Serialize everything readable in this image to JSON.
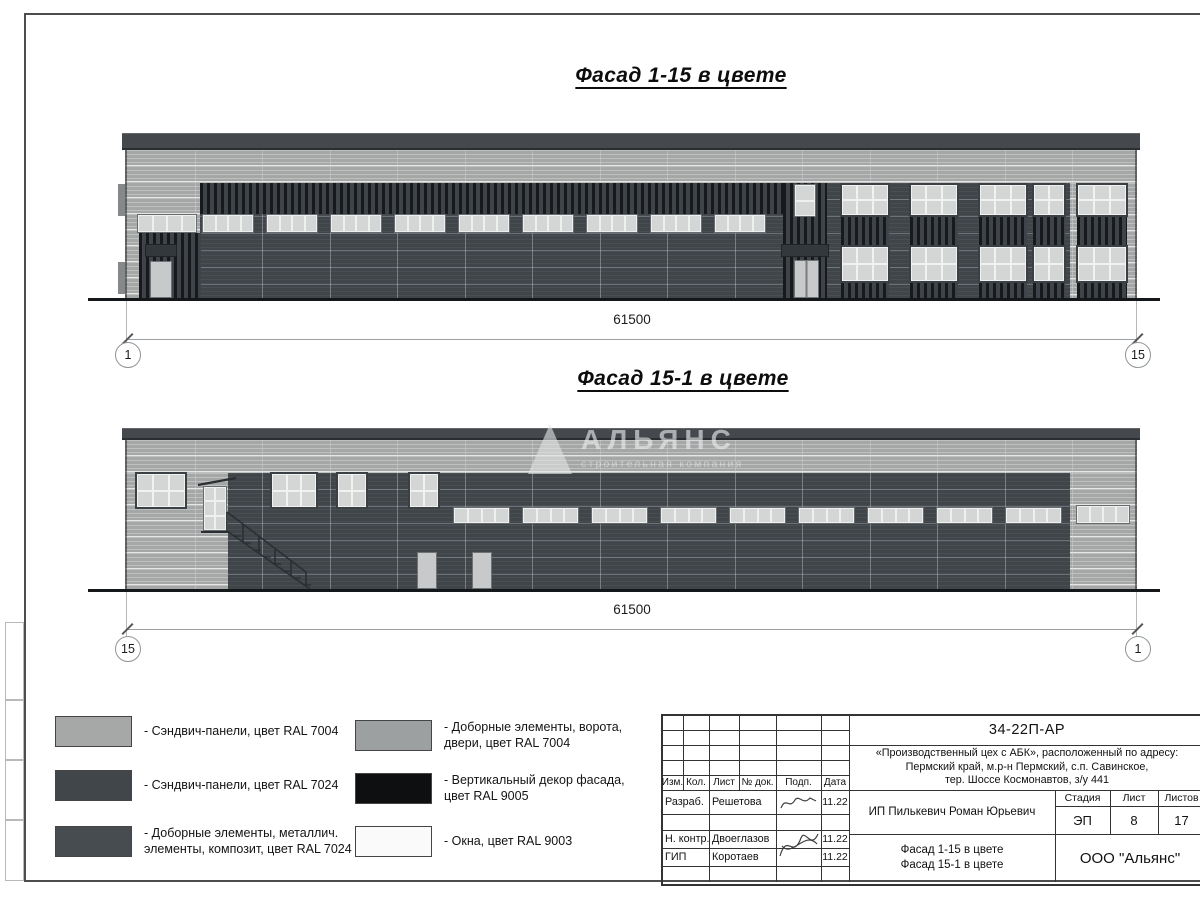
{
  "colors": {
    "panel_light": "#a5a7a6",
    "panel_dark": "#40454a",
    "decor_black": "#17191b",
    "cornice": "#45494d",
    "window_pane": "#d4d6d6",
    "door": "#c7c9ca"
  },
  "facades": [
    {
      "title": "Фасад 1-15 в цвете",
      "dim": "61500",
      "axis_left": "1",
      "axis_right": "15"
    },
    {
      "title": "Фасад 15-1 в цвете",
      "dim": "61500",
      "axis_left": "15",
      "axis_right": "1"
    }
  ],
  "watermark": {
    "name": "АЛЬЯНС",
    "subtitle": "строительная компания"
  },
  "legend": {
    "items": [
      {
        "color": "#a6a8a7",
        "label": "- Сэндвич-панели, цвет RAL 7004"
      },
      {
        "color": "#41464a",
        "label": "- Сэндвич-панели, цвет RAL 7024"
      },
      {
        "color": "#474c50",
        "label": "- Доборные элементы, металлич.\nэлементы, композит, цвет RAL 7024"
      },
      {
        "color": "#9da0a0",
        "label": "- Доборные элементы, ворота,\nдвери, цвет RAL 7004"
      },
      {
        "color": "#0d0f11",
        "label": "- Вертикальный декор фасада,\nцвет RAL 9005"
      },
      {
        "color": "#fafafa",
        "label": "- Окна, цвет RAL 9003"
      }
    ]
  },
  "title_block": {
    "doc_number": "34-22П-АР",
    "project_lines": [
      "«Производственный цех с АБК», расположенный по адресу:",
      "Пермский край, м.р-н Пермский, с.п. Савинское,",
      "тер. Шоссе Космонавтов, з/у 441"
    ],
    "header_cols": [
      "Изм.",
      "Кол.",
      "Лист",
      "№ док.",
      "Подп.",
      "Дата"
    ],
    "rows": [
      {
        "role": "Разраб.",
        "name": "Решетова",
        "date": "11.22"
      },
      {
        "role": "Н. контр.",
        "name": "Двоеглазов",
        "date": "11.22"
      },
      {
        "role": "ГИП",
        "name": "Коротаев",
        "date": "11.22"
      }
    ],
    "client": "ИП Пилькевич Роман Юрьевич",
    "stage_label": "Стадия",
    "sheet_label": "Лист",
    "sheets_label": "Листов",
    "stage": "ЭП",
    "sheet": "8",
    "sheets": "17",
    "sheet_title_lines": [
      "Фасад 1-15 в цвете",
      "Фасад 15-1 в цвете"
    ],
    "company": "ООО \"Альянс\""
  }
}
